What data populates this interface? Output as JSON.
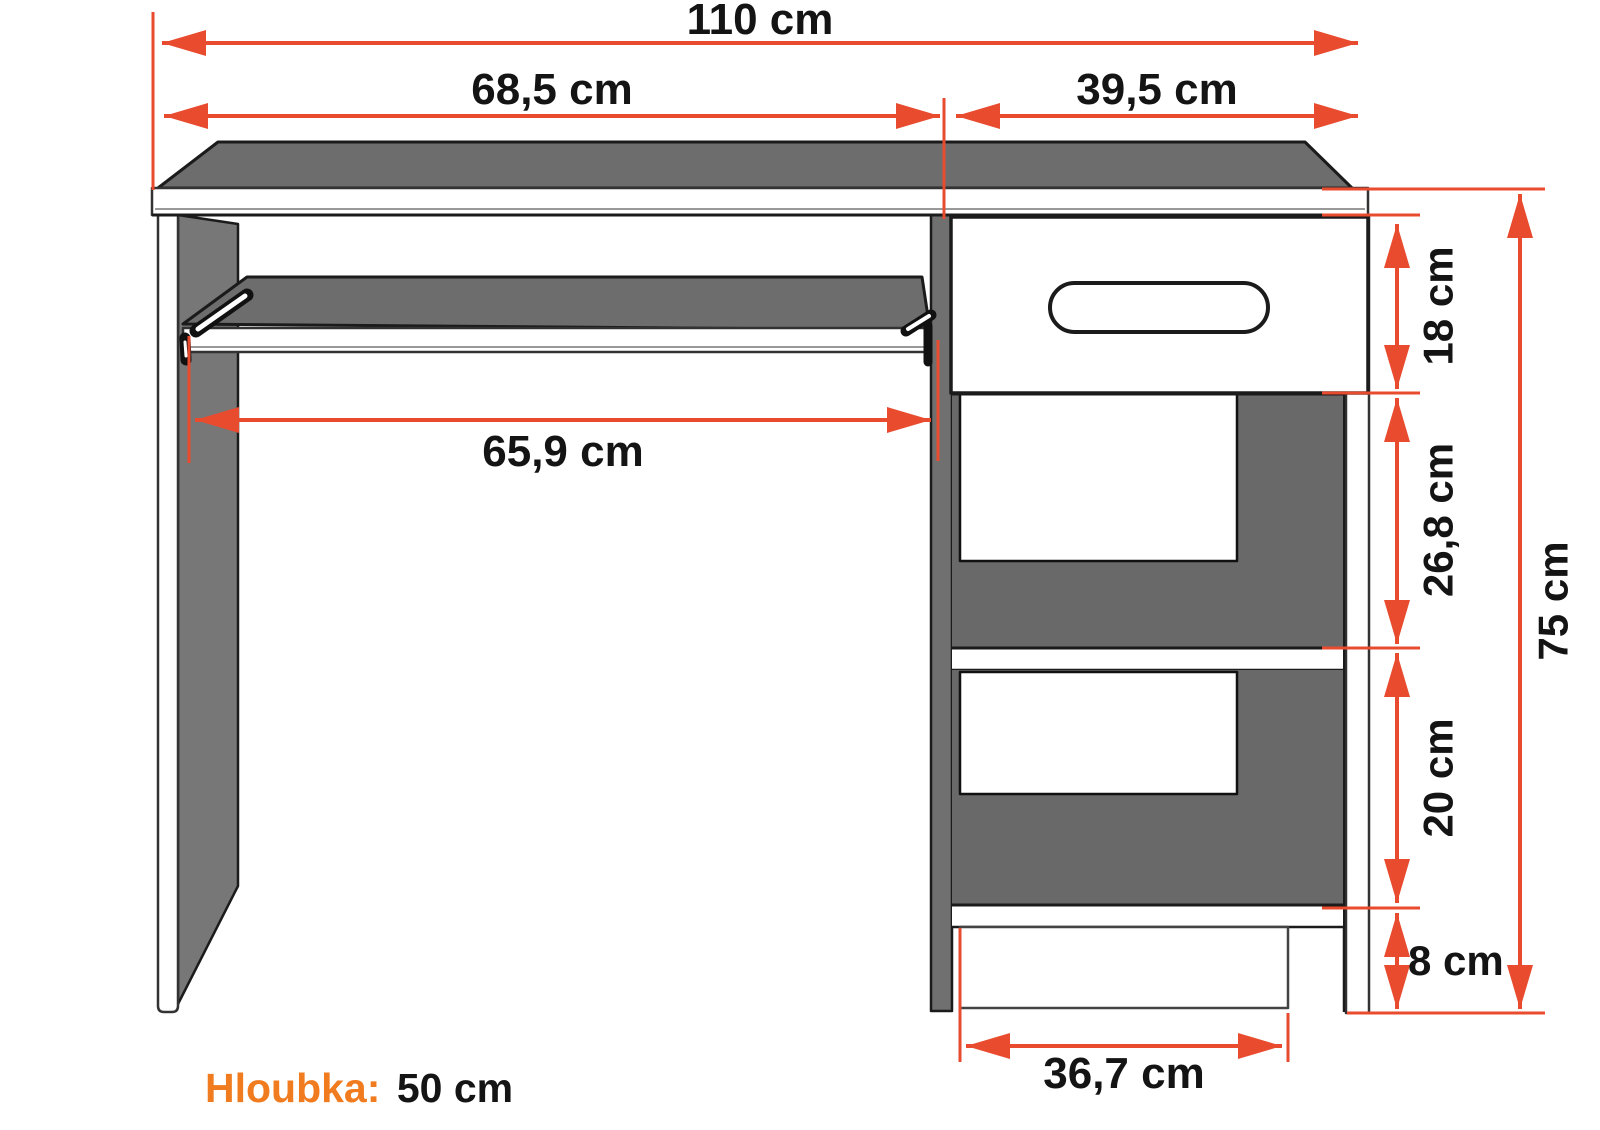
{
  "diagram": {
    "title": "desk-dimension-diagram",
    "dims": {
      "total_width": "110 cm",
      "desk_left_width": "68,5 cm",
      "cabinet_width": "39,5 cm",
      "tray_width": "65,9 cm",
      "drawer_height": "18 cm",
      "upper_shelf_height": "26,8 cm",
      "lower_shelf_height": "20 cm",
      "plinth_height": "8 cm",
      "total_height": "75 cm",
      "base_width": "36,7 cm"
    },
    "depth": {
      "label": "Hloubka:",
      "value": "50 cm"
    },
    "colors": {
      "dimension_arrow": "#e84b2e",
      "depth_accent": "#f07c1f",
      "desk_gray": "#6e6e6e",
      "outline": "#1b1b1b",
      "background": "#ffffff"
    }
  }
}
